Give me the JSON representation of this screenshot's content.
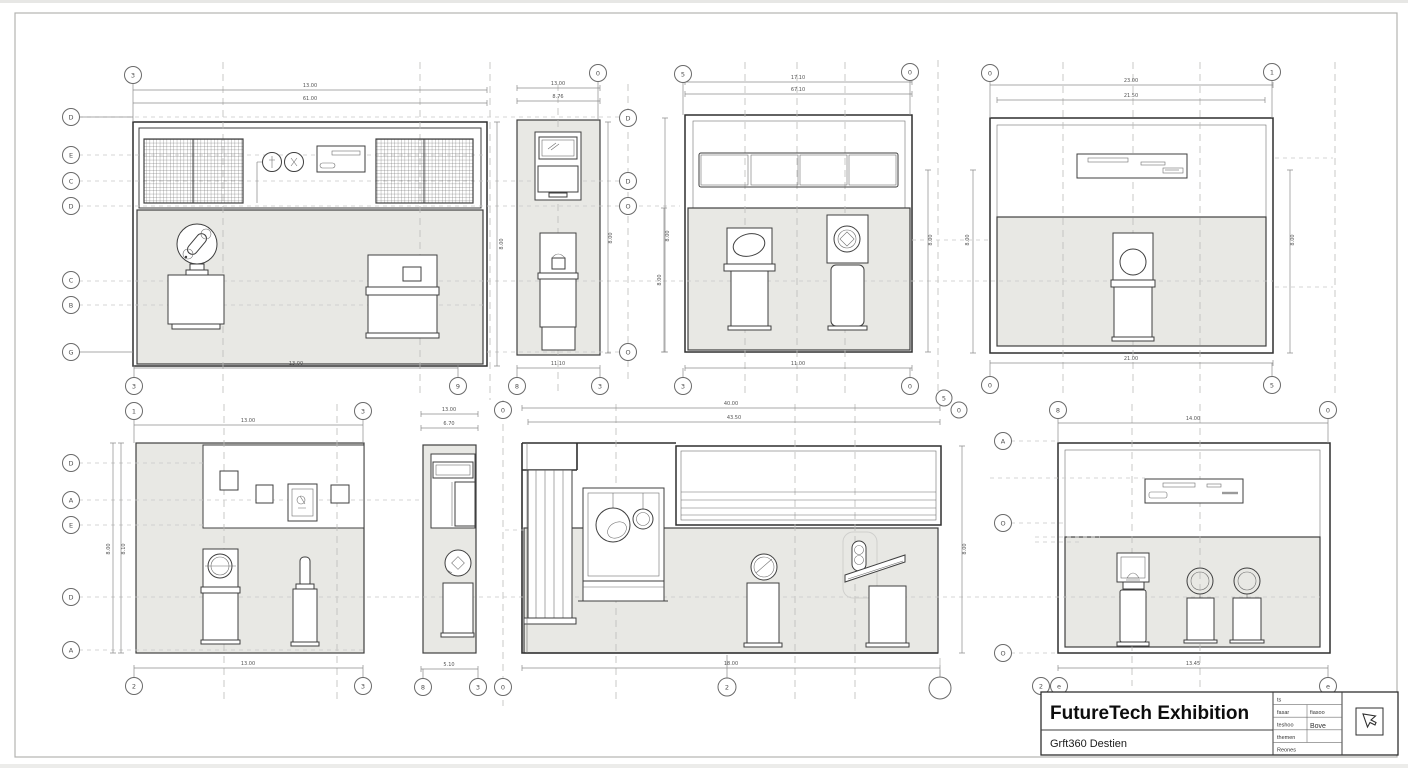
{
  "title_block": {
    "title": "FutureTech Exhibition",
    "subtitle": "Grft360 Destien",
    "rows": [
      "ts",
      "fasar",
      "teshoo",
      "themen",
      "Reones"
    ],
    "col2": {
      "r2": "fiasoo",
      "r3": "Bove"
    }
  },
  "panels": {
    "p1": {
      "dim_top1": "13.00",
      "dim_top2": "61.00",
      "dim_bottom": "13.00",
      "dim_right": "8.00",
      "bub_tl": "3",
      "bub_bl": "3",
      "bub_br": "9",
      "left_bubbles": [
        "D",
        "E",
        "C",
        "D",
        "C",
        "B",
        "G"
      ]
    },
    "p2": {
      "dim_top1": "13.00",
      "dim_top2": "8.76",
      "dim_bottom": "11.10",
      "dim_v1": "8.00",
      "dim_v2": "8.00",
      "bub_t": "0",
      "bub_bl": "8",
      "bub_br": "3",
      "right_bubbles": [
        "D",
        "D",
        "O",
        "O"
      ]
    },
    "p3": {
      "dim_top1": "17.10",
      "dim_top2": "67.10",
      "dim_bottom": "11.00",
      "dim_left": "8.00",
      "dim_right": "8.00",
      "bub_tl": "5",
      "bub_tr": "0",
      "bub_bl": "3",
      "bub_br": "0"
    },
    "p4": {
      "dim_top1": "23.00",
      "dim_top2": "21.50",
      "dim_bottom": "21.00",
      "dim_left": "8.00",
      "dim_right": "8.00",
      "bub_tl": "0",
      "bub_tr": "1",
      "bub_bl": "0",
      "bub_br": "5"
    },
    "p5": {
      "dim_top": "13.00",
      "dim_bottom": "13.00",
      "dim_v1": "8.00",
      "dim_v2": "8.10",
      "bub_tl": "1",
      "bub_tr": "3",
      "bub_bl": "2",
      "bub_br": "3",
      "left_bubbles": [
        "D",
        "A",
        "E",
        "D",
        "A"
      ]
    },
    "p6": {
      "dim_top1": "13.00",
      "dim_top2": "6.70",
      "dim_bottom": "5.10",
      "bub_t": "0",
      "bub_b1": "8",
      "bub_b2": "3",
      "bub_b3": "0"
    },
    "p7": {
      "dim_top1": "40.00",
      "dim_top2": "43.50",
      "dim_bottom": "18.00",
      "dim_right": "8.00",
      "bub_t1": "5",
      "bub_t2": "0",
      "bub_b": "2"
    },
    "p8": {
      "dim_top": "14.00",
      "dim_bottom": "13.45",
      "bub_tl": "8",
      "bub_tr": "0",
      "bub_b1": "2",
      "bub_b2": "e",
      "bub_b3": "e",
      "left_bubbles": [
        "A",
        "O",
        "O"
      ]
    }
  }
}
